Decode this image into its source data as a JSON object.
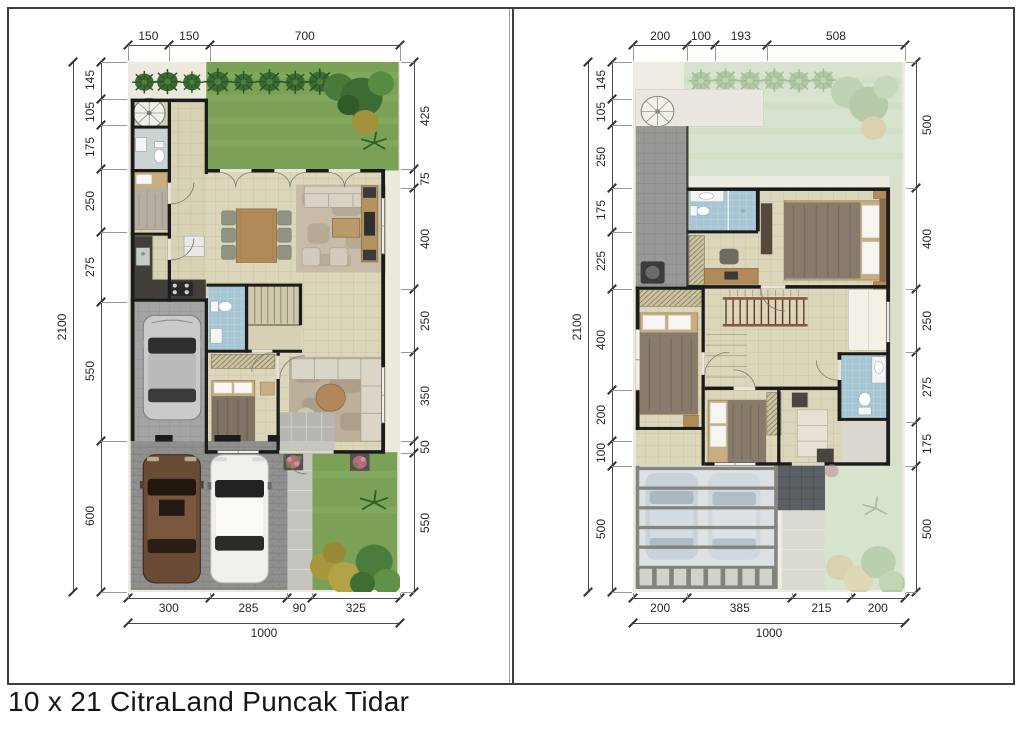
{
  "title": "10 x 21 CitraLand Puncak Tidar",
  "panels": {
    "ground_floor": {
      "dims": {
        "top": [
          150,
          150,
          700
        ],
        "left": [
          145,
          105,
          175,
          250,
          275,
          550,
          600
        ],
        "left_total": 2100,
        "right": [
          425,
          75,
          400,
          250,
          350,
          50,
          550
        ],
        "bottom": [
          300,
          285,
          90,
          325
        ],
        "bottom_total": 1000
      }
    },
    "upper_floor": {
      "dims": {
        "top": [
          200,
          100,
          193,
          508
        ],
        "left": [
          145,
          105,
          250,
          175,
          225,
          400,
          200,
          100,
          500
        ],
        "left_total": 2100,
        "right": [
          500,
          400,
          250,
          275,
          175,
          500
        ],
        "bottom": [
          200,
          385,
          215,
          200
        ],
        "bottom_total": 1000
      }
    }
  },
  "colors": {
    "grass": "#7aa156",
    "faded_grass": "#ccdcc0",
    "floor": "#dcd6ba",
    "wall": "#1b1b1b",
    "bath_tile": "#a6c5d2",
    "carport": "#a4a4a2",
    "driveway": "#8f8f8d",
    "dim_text": "#262626"
  }
}
